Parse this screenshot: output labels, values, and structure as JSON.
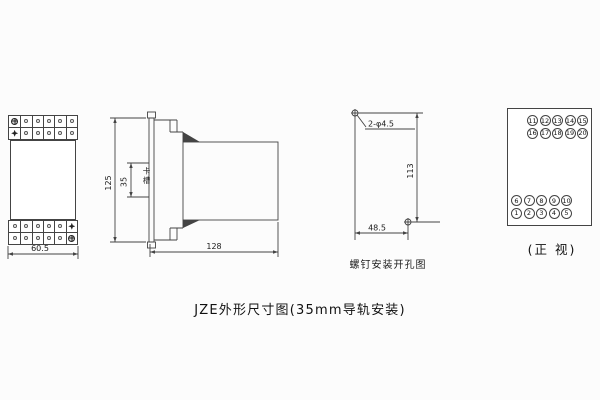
{
  "page": {
    "title": "JZE外形尺寸图(35mm导轨安装)",
    "background": "#fcfcfc",
    "line_color": "#444444"
  },
  "front_view": {
    "width_dim": "60.5"
  },
  "side_view": {
    "height_dim": "125",
    "slot_dim": "35",
    "slot_label": "卡槽",
    "depth_dim": "128"
  },
  "drill_view": {
    "holes_label": "2-φ4.5",
    "vertical_dim": "113",
    "horizontal_dim": "48.5",
    "caption": "螺钉安装开孔图"
  },
  "terminal_view": {
    "caption": "(正 视)",
    "rows": [
      [
        "11",
        "12",
        "13",
        "14",
        "15"
      ],
      [
        "16",
        "17",
        "18",
        "19",
        "20"
      ],
      [
        "6",
        "7",
        "8",
        "9",
        "10"
      ],
      [
        "1",
        "2",
        "3",
        "4",
        "5"
      ]
    ]
  },
  "icons": {
    "screw": "circle-with-cross-slot",
    "star": "four-point-star",
    "hole": "circle-crosshair"
  }
}
